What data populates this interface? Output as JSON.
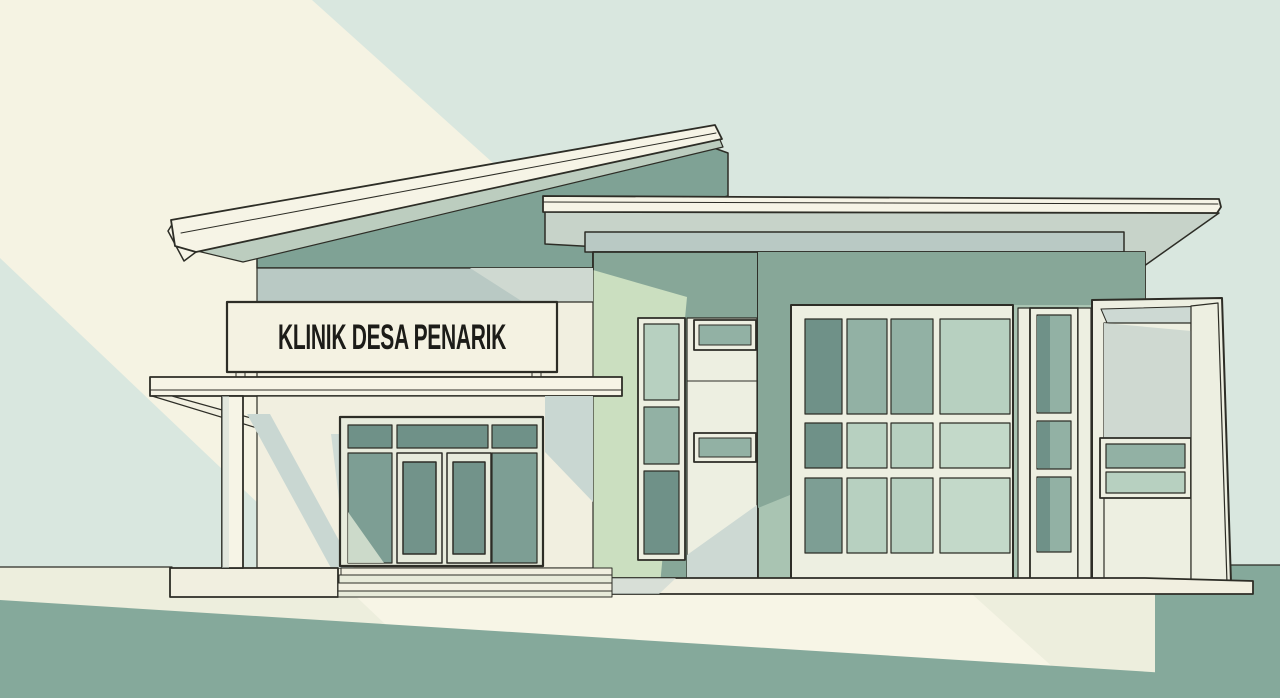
{
  "sign": {
    "title": "KLINIK DESA PENARIK"
  },
  "scene": {
    "alt": "Flat illustration of a single-storey village clinic facade with two slanted roofs, an entrance canopy with glass double doors, a large gridded window wall and diagonal light bands"
  },
  "palette": {
    "sky": "#d9e7df",
    "light_beam": "#f5f3e3",
    "light_beam_bright": "#f7f5e6",
    "walkway": "#edeedd",
    "lawn": "#85a99b",
    "roof_fascia": "#f6f4e6",
    "roof_underside": "#c7d3c9",
    "roof_wedge": "#bccdbf",
    "parapet_blue": "#b9c9c4",
    "parapet_blue_light": "#cfd9d1",
    "wall_dark_sage": "#87a798",
    "wall_darker_sage": "#7fa295",
    "wall_mid_sage": "#a9c4b2",
    "wall_lit_green": "#cbdfc0",
    "wall_cream": "#f1efe0",
    "frame_white": "#edefe1",
    "frame_shadow": "#cdd9d3",
    "shadow_blue": "#c9d7d2",
    "sign_bg": "#f4f2e2",
    "sign_text": "#1c1c18",
    "door_frame": "#e7ebdc",
    "door_glass": "#72938a",
    "glass_dark": "#6f9188",
    "glass_teal": "#7d9e94",
    "glass_mid": "#92b1a4",
    "glass_light": "#b7d0c0",
    "glass_lighter": "#c3d9c9",
    "glass_lit": "#e0e8d7",
    "step_mid": "#e7ead9",
    "outline": "#2d2d26"
  }
}
